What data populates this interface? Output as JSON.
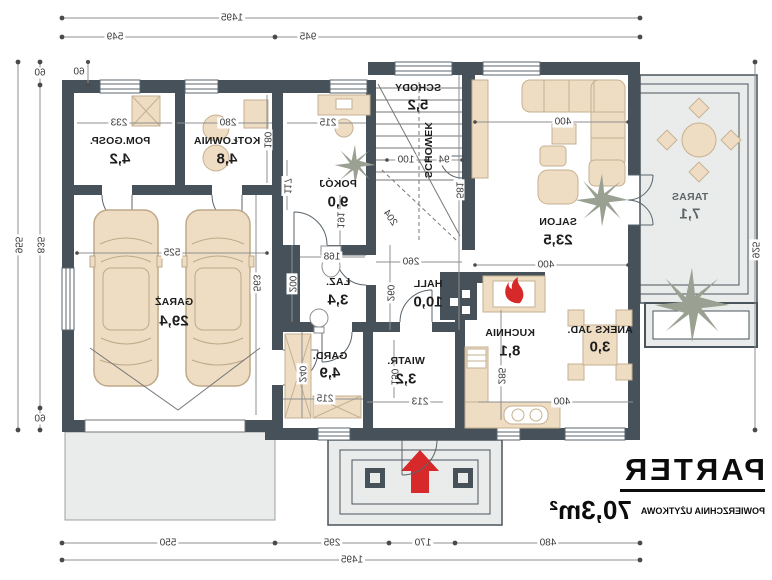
{
  "title": {
    "floor": "PARTER",
    "area_label": "POWIERZCHNIA UŻYTKOWA",
    "area_value": "70,3m²"
  },
  "rooms": {
    "salon": {
      "name": "SALON",
      "area": "23,5"
    },
    "taras": {
      "name": "TARAS",
      "area": "7,1"
    },
    "kuchnia": {
      "name": "KUCHNIA",
      "area": "8,1"
    },
    "aneks": {
      "name": "ANEKS JAD.",
      "area": "3,0"
    },
    "hall": {
      "name": "HALL",
      "area": "10,0"
    },
    "wiatr": {
      "name": "WIATR.",
      "area": "3,2"
    },
    "gard": {
      "name": "GARD.",
      "area": "4,9"
    },
    "laz": {
      "name": "ŁAZ.",
      "area": "3,4"
    },
    "pokoj": {
      "name": "POKÓJ",
      "area": "9,0"
    },
    "schody": {
      "name": "SCHODY",
      "area": "5,2"
    },
    "schowek": {
      "name": "SCHOWEK"
    },
    "kotlownia": {
      "name": "KOTŁOWNIA",
      "area": "4,8"
    },
    "pomgosp": {
      "name": "POM.GOSP.",
      "area": "4,2"
    },
    "garaz": {
      "name": "GARAŻ",
      "area": "29,4"
    }
  },
  "dims": {
    "top_total": "1495",
    "top_main": "945",
    "top_garage": "549",
    "bottom_s1": "480",
    "bottom_s2": "170",
    "bottom_s3": "295",
    "bottom_s4": "550",
    "bottom_total": "1495",
    "left_total": "925",
    "right_total": "955",
    "right_inner": "835",
    "right_60_top": "60",
    "right_60_bottom": "60",
    "garage_top_60": "60",
    "pomgosp_w": "233",
    "kotlownia_w": "280",
    "kotlownia_h": "180",
    "pokoj_w": "215",
    "pokoj_h": "117",
    "schody_w1": "94",
    "schody_w2": "100",
    "schody_d": "204",
    "hall_top_h": "191",
    "laz_w": "168",
    "laz_h": "200",
    "salon_w_top": "400",
    "salon_w_bottom": "400",
    "salon_h": "581",
    "hall_w": "260",
    "hall_h": "260",
    "kuchnia_h": "285",
    "kuchnia_w": "400",
    "wiatr_w": "213",
    "wiatr_h": "150",
    "gard_w": "215",
    "gard_h": "240",
    "garaz_w": "525",
    "garaz_h": "563"
  },
  "icons": {
    "entrance": "arrow-up",
    "fireplace": "flame",
    "plants": "star-plant"
  },
  "colors": {
    "wall": "#47515a",
    "furniture": "#eedcc3",
    "terrace": "#e9eceb",
    "accent_red": "#d7282a"
  }
}
